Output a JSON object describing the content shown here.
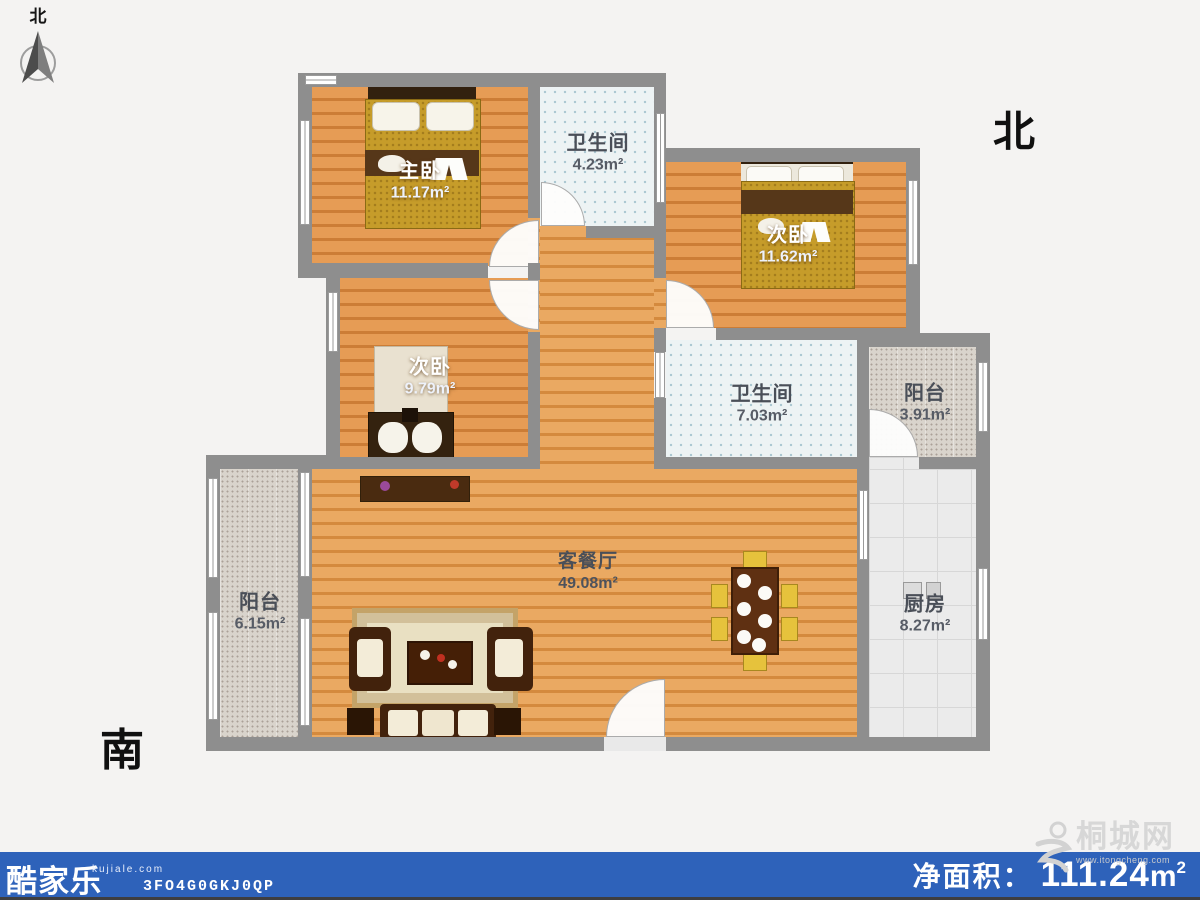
{
  "compass": {
    "north_char": "北"
  },
  "orientation": {
    "north_label": "北",
    "south_label": "南"
  },
  "rooms": [
    {
      "id": "master-bedroom",
      "name": "主卧",
      "area": "11.17",
      "unit": "m²"
    },
    {
      "id": "bathroom-top",
      "name": "卫生间",
      "area": "4.23",
      "unit": "m²"
    },
    {
      "id": "bedroom-ne",
      "name": "次卧",
      "area": "11.62",
      "unit": "m²"
    },
    {
      "id": "bedroom-west",
      "name": "次卧",
      "area": "9.79",
      "unit": "m²"
    },
    {
      "id": "bathroom-mid",
      "name": "卫生间",
      "area": "7.03",
      "unit": "m²"
    },
    {
      "id": "balcony-east",
      "name": "阳台",
      "area": "3.91",
      "unit": "m²"
    },
    {
      "id": "kitchen",
      "name": "厨房",
      "area": "8.27",
      "unit": "m²"
    },
    {
      "id": "balcony-west",
      "name": "阳台",
      "area": "6.15",
      "unit": "m²"
    },
    {
      "id": "living-dining",
      "name": "客餐厅",
      "area": "49.08",
      "unit": "m²"
    }
  ],
  "footer": {
    "brand": "酷家乐",
    "brand_domain": "kujiale.com",
    "plan_code": "3FO4G0GKJ0QP",
    "net_area": {
      "label": "净面积：",
      "value": "111.24",
      "unit_base": "m",
      "unit_sup": "2"
    },
    "bar_color": "#2e62ba"
  },
  "watermark": {
    "site_name": "桐城网",
    "site_url": "www.itongcheng.com"
  }
}
